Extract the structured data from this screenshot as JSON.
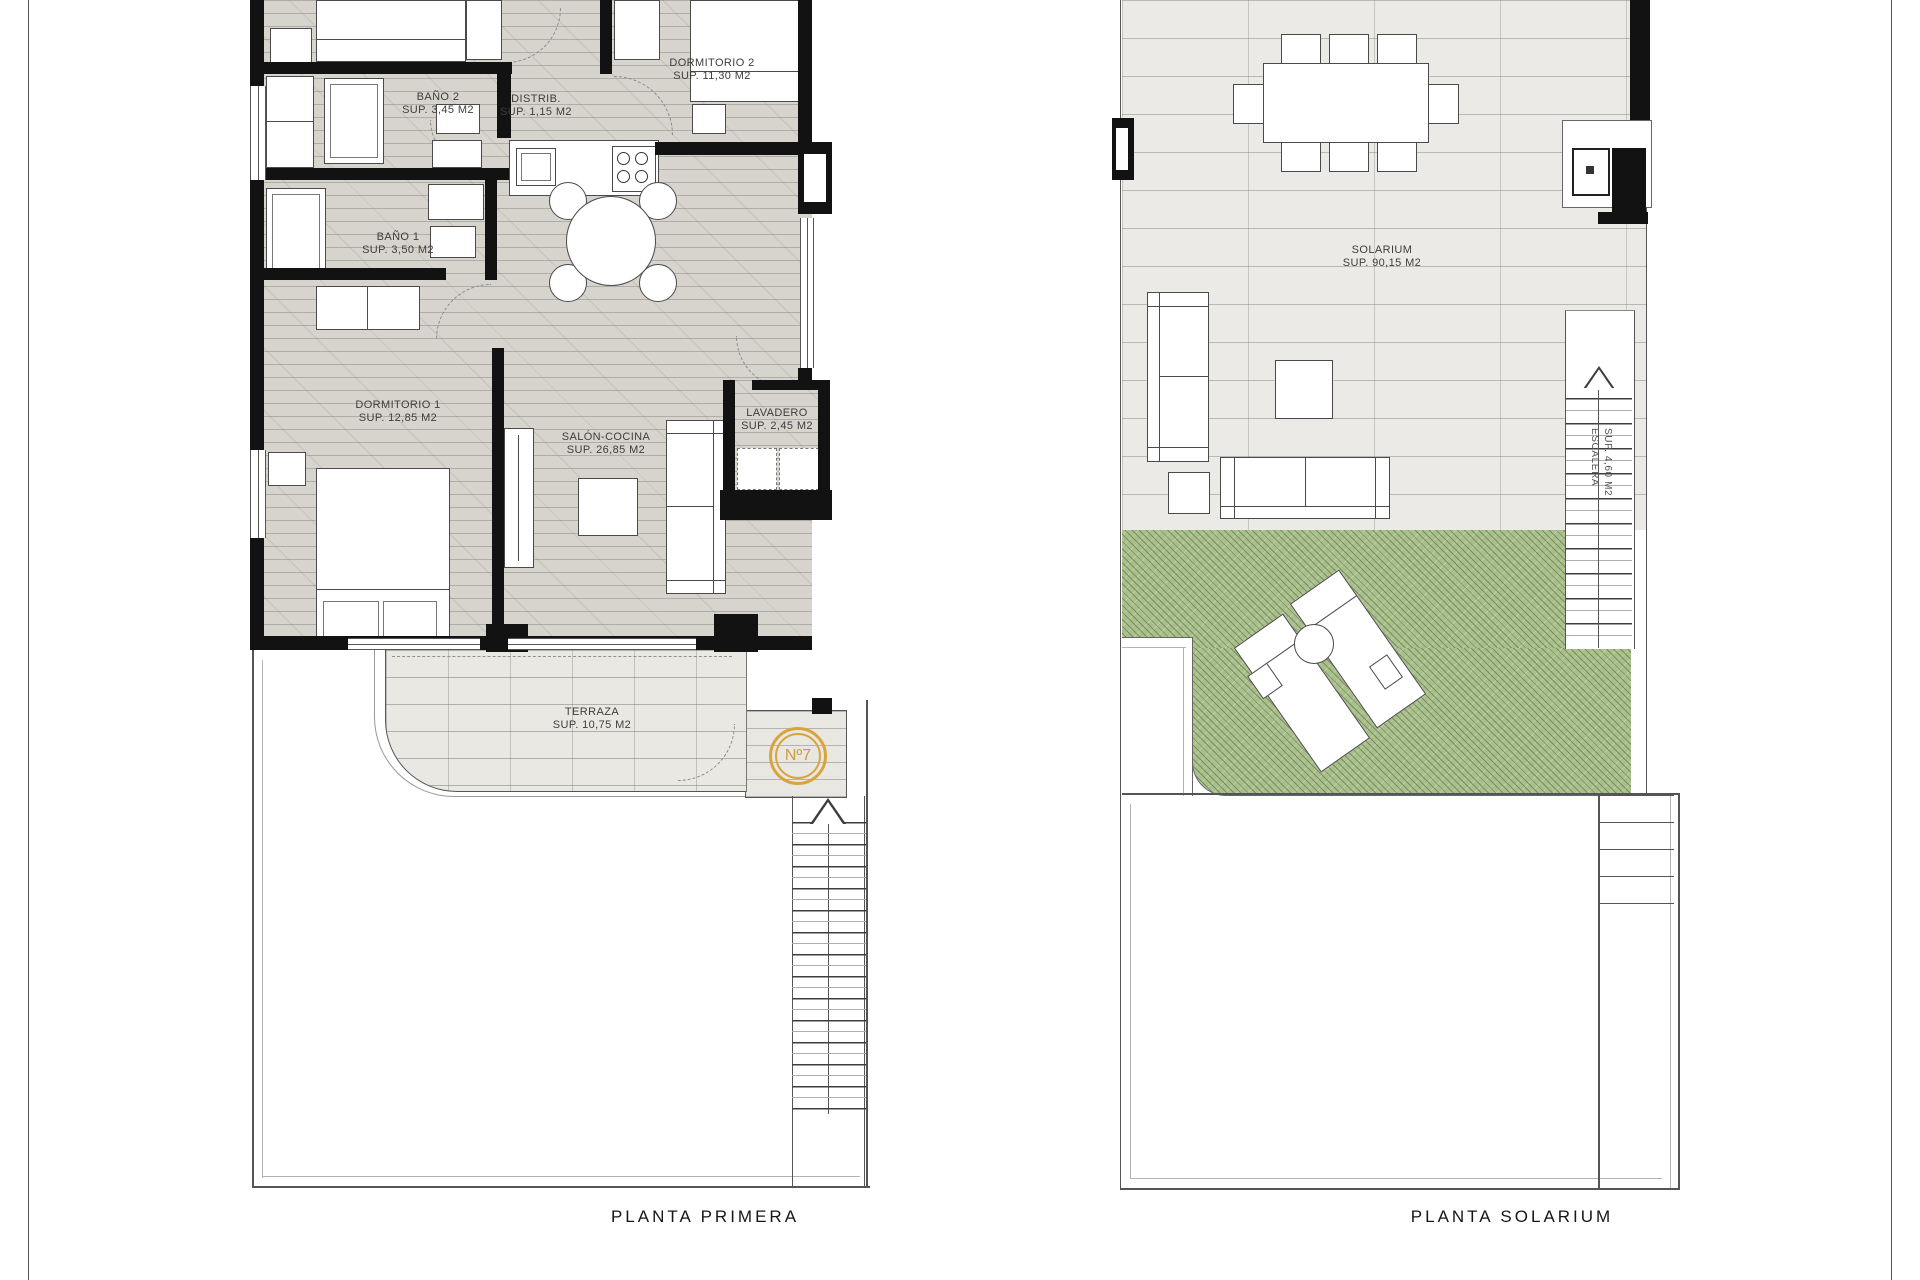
{
  "sheet": {
    "captions": {
      "primera": "PLANTA PRIMERA",
      "solarium": "PLANTA SOLARIUM"
    }
  },
  "plans": {
    "primera": {
      "caption": "PLANTA PRIMERA",
      "unit_badge": "Nº7",
      "rooms": [
        {
          "id": "dormitorio-2",
          "name": "DORMITORIO 2",
          "area": "SUP. 11,30 M2"
        },
        {
          "id": "bano-2",
          "name": "BAÑO 2",
          "area": "SUP. 3,45 M2"
        },
        {
          "id": "distribuidor",
          "name": "DISTRIB.",
          "area": "SUP. 1,15 M2"
        },
        {
          "id": "bano-1",
          "name": "BAÑO 1",
          "area": "SUP. 3,50 M2"
        },
        {
          "id": "dormitorio-1",
          "name": "DORMITORIO 1",
          "area": "SUP. 12,85 M2"
        },
        {
          "id": "salon-cocina",
          "name": "SALÓN-COCINA",
          "area": "SUP. 26,85 M2"
        },
        {
          "id": "lavadero",
          "name": "LAVADERO",
          "area": "SUP. 2,45 M2"
        },
        {
          "id": "terraza",
          "name": "TERRAZA",
          "area": "SUP. 10,75 M2"
        }
      ]
    },
    "solarium": {
      "caption": "PLANTA SOLARIUM",
      "rooms": [
        {
          "id": "solarium",
          "name": "SOLARIUM",
          "area": "SUP. 90,15 M2"
        },
        {
          "id": "escalera",
          "name": "ESCALERA",
          "area": "SUP. 4,60 M2"
        }
      ]
    }
  },
  "colors": {
    "wall": "#121212",
    "wood_floor": "#d7d3cd",
    "terrace_tile": "#eae8e3",
    "solarium_tile": "#eceae6",
    "grass": "#a9bf8c",
    "badge_orange": "#d9a43e",
    "boundary_line": "#555555"
  }
}
